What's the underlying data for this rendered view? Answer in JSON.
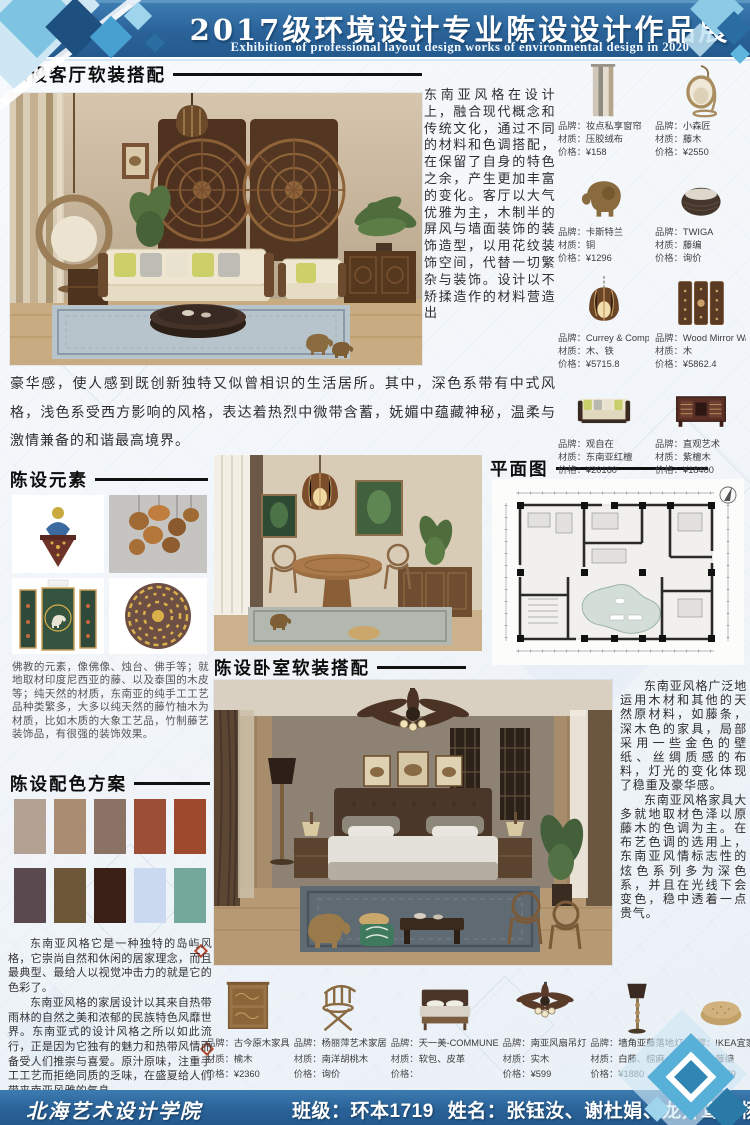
{
  "header": {
    "title": "2017级环境设计专业陈设设计作品展",
    "subtitle": "Exhibition of professional layout design works of environmental design in 2020"
  },
  "footer": {
    "school": "北海艺术设计学院",
    "class_label": "班级：环本1719",
    "names_label": "姓名：张钰汝、谢杜娟、龙开鸾、杨芳、孙怀鑫"
  },
  "labels": {
    "brand": "品牌：",
    "material": "材质：",
    "price": "价格："
  },
  "sections": {
    "living": {
      "title": "陈设客厅软装搭配",
      "side_paragraph": "东南亚风格在设计上，融合现代概念和传统文化，通过不同的材料和色调搭配，在保留了自身的特色之余，产生更加丰富的变化。客厅以大气优雅为主，木制半的屏风与墙面装饰的装饰造型，以用花纹装饰空间，代替一切繁杂与装饰。设计以不矫揉造作的材料营造出",
      "bottom_paragraph": "豪华感，使人感到既创新独特又似曾相识的生活居所。其中，深色系带有中式风格，浅色系受西方影响的风格，表达着热烈中微带含蓄，妩媚中蕴藏神秘，温柔与激情兼备的和谐最高境界。"
    },
    "elements": {
      "title": "陈设元素",
      "paragraph": "佛教的元素，像佛像、烛台、佛手等；就地取材印度尼西亚的藤、以及泰国的木皮等；纯天然的材质，东南亚的纯手工工艺品种类繁多，大多以纯天然的藤竹柚木为材质，比如木质的大象工艺品，竹制藤艺装饰品，有很强的装饰效果。"
    },
    "plan": {
      "title": "平面图"
    },
    "bedroom": {
      "title": "陈设卧室软装搭配",
      "paragraph1": "东南亚风格广泛地运用木材和其他的天然原材料，如藤条，深木色的家具，局部采用一些金色的壁纸、丝绸质感的布料，灯光的变化体现了稳重及豪华感。",
      "paragraph2": "东南亚风格家具大多就地取材色泽以原藤木的色调为主。在布艺色调的选用上，东南亚风情标志性的炫色系列多为深色系，并且在光线下会变色，稳中透着一点贵气。"
    },
    "palette": {
      "title": "陈设配色方案",
      "swatches": [
        "#b3a294",
        "#a98c71",
        "#8a7364",
        "#9d4e37",
        "#9e492c",
        "#5b4950",
        "#6e5738",
        "#3a2017",
        "#cbd9f0",
        "#73a89a"
      ],
      "paragraph1": "东南亚风格它是一种独特的岛屿风格，它崇尚自然和休闲的居家理念，而且最典型、最给人以视觉冲击力的就是它的色彩了。",
      "paragraph2": "东南亚风格的家居设计以其来自热带雨林的自然之美和浓郁的民族特色风靡世界。东南亚式的设计风格之所以如此流行，正是因为它独有的魅力和热带风情而备受人们推崇与喜爱。原汁原味，注重手工工艺而拒绝同质的乏味，在盛夏给人们带来南亚风雅的气息。"
    }
  },
  "products_right": [
    {
      "brand": "妆点私享窗帘",
      "material": "压胶绒布",
      "price": "¥158",
      "icon": "curtain-icon"
    },
    {
      "brand": "小森匠",
      "material": "藤木",
      "price": "¥2550",
      "icon": "hanging-chair-icon"
    },
    {
      "brand": "卡斯特兰",
      "material": "铜",
      "price": "¥1296",
      "icon": "elephant-icon"
    },
    {
      "brand": "TWIGA",
      "material": "藤编",
      "price": "询价",
      "icon": "rattan-stool-icon"
    },
    {
      "brand": "Currey & Company",
      "material": "木、铁",
      "price": "¥5715.8",
      "icon": "pendant-lamp-icon"
    },
    {
      "brand": "Wood Mirror Wall Pane",
      "material": "木",
      "price": "¥5862.4",
      "icon": "wall-panels-icon"
    },
    {
      "brand": "观自在",
      "material": "东南亚红檀",
      "price": "¥20160",
      "icon": "sofa-icon"
    },
    {
      "brand": "直观艺术",
      "material": "紫檀木",
      "price": "¥18400",
      "icon": "tv-cabinet-icon"
    }
  ],
  "products_bottom": [
    {
      "brand": "古今原木家具",
      "material": "榆木",
      "price": "¥2360",
      "icon": "nightstand-icon"
    },
    {
      "brand": "杨丽萍艺术家居",
      "material": "南洋胡桃木",
      "price": "询价",
      "icon": "folding-chair-icon"
    },
    {
      "brand": "天一美-COMMUNE",
      "material": "软包、皮革",
      "price": "",
      "icon": "bed-icon"
    },
    {
      "brand": "南亚风扇吊灯",
      "material": "实木",
      "price": "¥599",
      "icon": "ceiling-fan-icon"
    },
    {
      "brand": "墙角亚藤落地灯",
      "material": "白藤、棕麻",
      "price": "¥1880",
      "icon": "floor-lamp-icon"
    },
    {
      "brand": "IKEA宜家",
      "material": "藤编",
      "price": "¥179",
      "icon": "pouf-icon"
    }
  ],
  "theme": {
    "banner_blue": "#2a6298",
    "accent_light_blue": "#7cc0e0",
    "deep_blue": "#1d4f7f",
    "line_black": "#111111"
  }
}
